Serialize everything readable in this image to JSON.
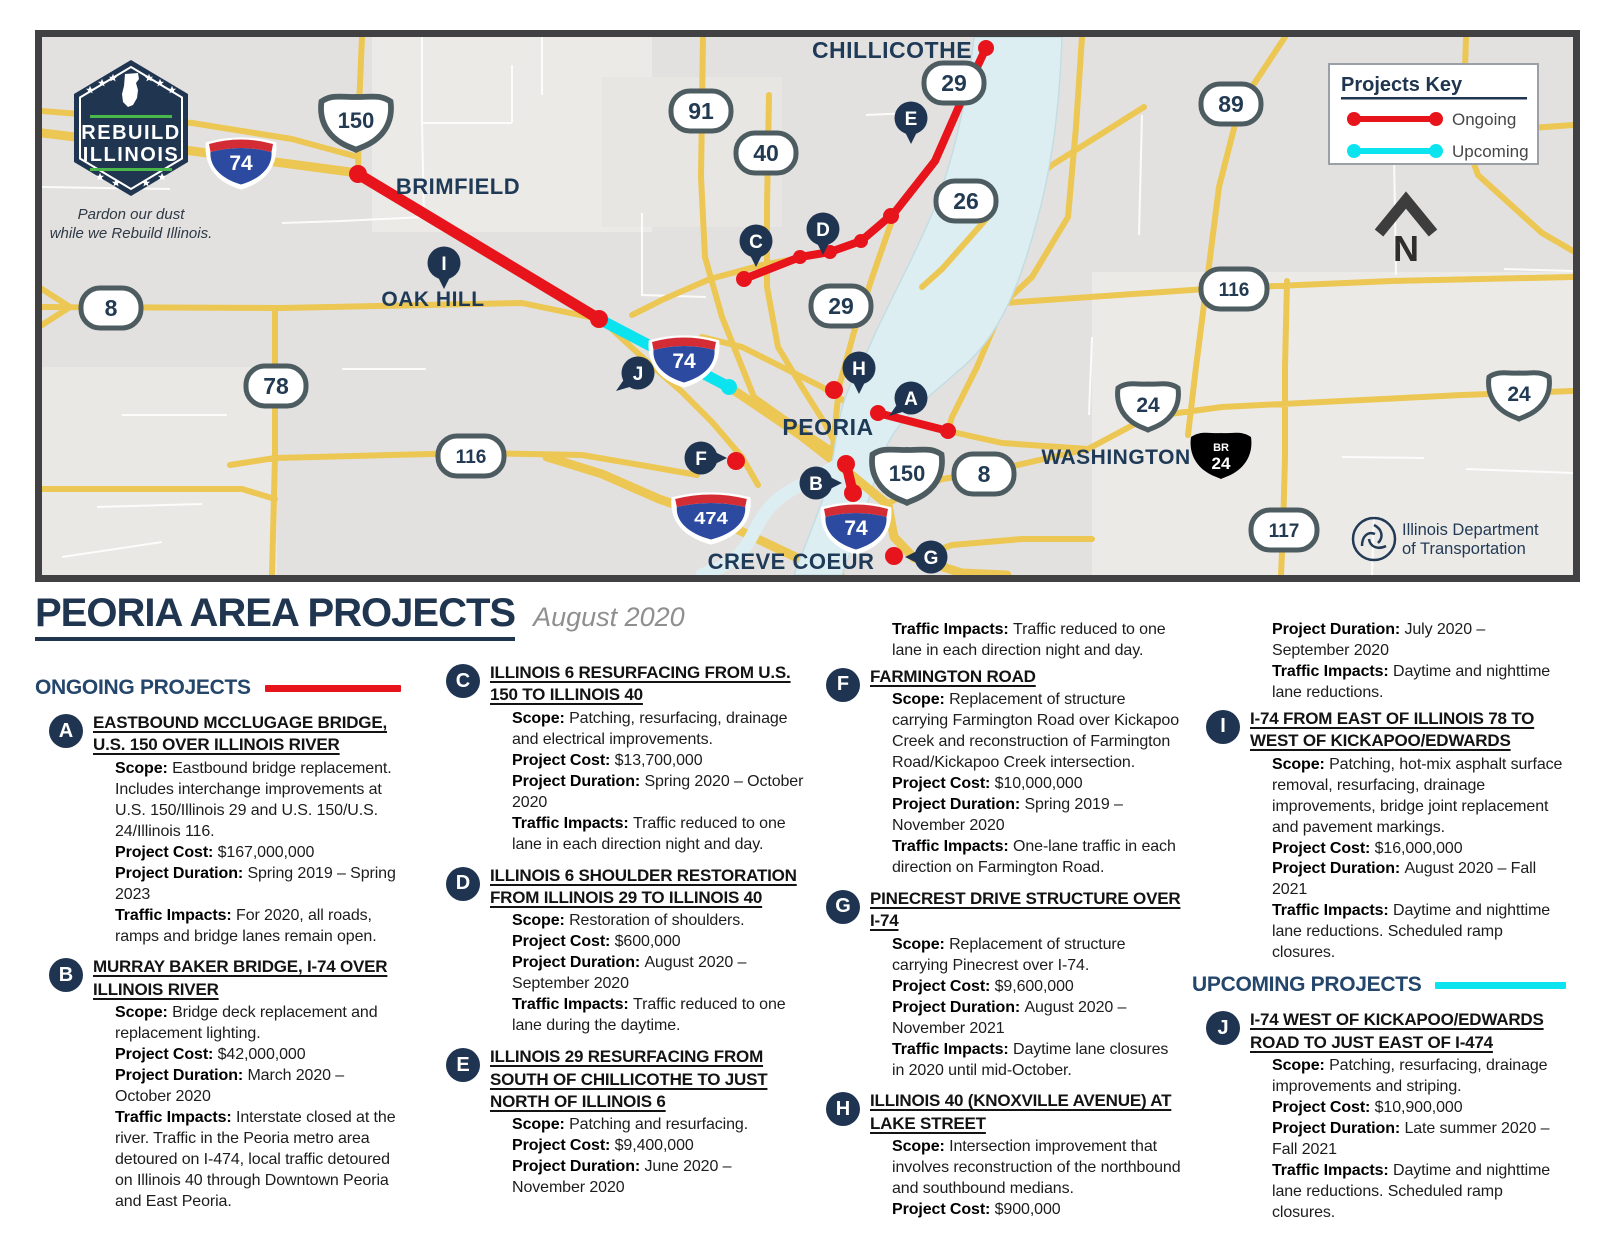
{
  "header": {
    "title": "PEORIA AREA PROJECTS",
    "date": "August 2020"
  },
  "sections": {
    "ongoing": {
      "label": "ONGOING PROJECTS",
      "color": "#e8141c"
    },
    "upcoming": {
      "label": "UPCOMING PROJECTS",
      "color": "#0be4ef"
    }
  },
  "labels": {
    "scope": "Scope:",
    "cost": "Project Cost:",
    "duration": "Project Duration:",
    "impacts": "Traffic Impacts:"
  },
  "map": {
    "legend": {
      "title": "Projects Key",
      "ongoing": "Ongoing",
      "upcoming": "Upcoming",
      "ongoing_color": "#e8141c",
      "upcoming_color": "#0be4ef"
    },
    "compass": "N",
    "rebuild": {
      "l1": "REBUILD",
      "l2": "ILLINOIS",
      "t1": "Pardon our dust",
      "t2": "while we Rebuild Illinois."
    },
    "idot": {
      "l1": "Illinois Department",
      "l2": "of Transportation"
    },
    "cities": {
      "brimfield": "BRIMFIELD",
      "oakhill": "OAK HILL",
      "chillicothe": "CHILLICOTHE",
      "peoria": "PEORIA",
      "washington": "WASHINGTON",
      "crevecoeur": "CREVE COEUR"
    },
    "shields": {
      "r8": "8",
      "r78": "78",
      "r91": "91",
      "r40": "40",
      "r29": "29",
      "r26": "26",
      "r89": "89",
      "r116": "116",
      "r117": "117",
      "us150": "150",
      "us24": "24",
      "br": "BR",
      "br24": "24",
      "i74": "74",
      "i474": "474"
    },
    "markers": {
      "a": "A",
      "b": "B",
      "c": "C",
      "d": "D",
      "e": "E",
      "f": "F",
      "g": "G",
      "h": "H",
      "i": "I",
      "j": "J"
    }
  },
  "columns": [
    {
      "blocks": [
        {
          "kind": "section",
          "section": "ongoing"
        },
        {
          "kind": "project",
          "letter": "A",
          "title": "EASTBOUND MCCLUGAGE BRIDGE, U.S. 150 OVER ILLINOIS RIVER",
          "details": [
            [
              "scope",
              "Eastbound bridge replacement. Includes interchange improvements at U.S. 150/Illinois 29 and U.S. 150/U.S. 24/Illinois 116."
            ],
            [
              "cost",
              "$167,000,000"
            ],
            [
              "duration",
              "Spring 2019 – Spring 2023"
            ],
            [
              "impacts",
              "For 2020, all roads, ramps and bridge lanes remain open."
            ]
          ]
        },
        {
          "kind": "project",
          "letter": "B",
          "title": "MURRAY BAKER BRIDGE, I-74 OVER ILLINOIS RIVER",
          "details": [
            [
              "scope",
              "Bridge deck replacement and replacement lighting."
            ],
            [
              "cost",
              "$42,000,000"
            ],
            [
              "duration",
              "March 2020 – October 2020"
            ],
            [
              "impacts",
              "Interstate closed at the river. Traffic in the Peoria metro area detoured on I-474, local traffic detoured on Illinois 40 through Downtown Peoria and East Peoria."
            ]
          ]
        }
      ]
    },
    {
      "blocks": [
        {
          "kind": "project",
          "letter": "C",
          "title": "ILLINOIS 6 RESURFACING FROM U.S. 150 TO ILLINOIS 40",
          "details": [
            [
              "scope",
              "Patching, resurfacing, drainage and electrical improvements."
            ],
            [
              "cost",
              "$13,700,000"
            ],
            [
              "duration",
              "Spring 2020 – October 2020"
            ],
            [
              "impacts",
              "Traffic reduced to one lane in each direction night and day."
            ]
          ]
        },
        {
          "kind": "project",
          "letter": "D",
          "title": "ILLINOIS 6 SHOULDER RESTORATION FROM ILLINOIS 29 TO ILLINOIS 40",
          "details": [
            [
              "scope",
              "Restoration of shoulders."
            ],
            [
              "cost",
              "$600,000"
            ],
            [
              "duration",
              "August 2020 – September 2020"
            ],
            [
              "impacts",
              "Traffic reduced to one lane during the daytime."
            ]
          ]
        },
        {
          "kind": "project",
          "letter": "E",
          "title": "ILLINOIS 29 RESURFACING FROM SOUTH OF CHILLICOTHE TO JUST NORTH OF ILLINOIS 6",
          "details": [
            [
              "scope",
              "Patching and resurfacing."
            ],
            [
              "cost",
              "$9,400,000"
            ],
            [
              "duration",
              "June 2020 – November 2020"
            ]
          ]
        }
      ]
    },
    {
      "blocks": [
        {
          "kind": "cont",
          "details": [
            [
              "impacts",
              "Traffic reduced to one lane in each direction night and day."
            ]
          ]
        },
        {
          "kind": "project",
          "letter": "F",
          "title": "FARMINGTON ROAD",
          "details": [
            [
              "scope",
              "Replacement of structure carrying Farmington Road over Kickapoo Creek and reconstruction of Farmington Road/Kickapoo Creek intersection."
            ],
            [
              "cost",
              "$10,000,000"
            ],
            [
              "duration",
              "Spring 2019 – November 2020"
            ],
            [
              "impacts",
              "One-lane traffic in each direction on Farmington Road."
            ]
          ]
        },
        {
          "kind": "project",
          "letter": "G",
          "title": "PINECREST DRIVE STRUCTURE OVER I-74",
          "details": [
            [
              "scope",
              "Replacement of structure carrying Pinecrest over I-74."
            ],
            [
              "cost",
              "$9,600,000"
            ],
            [
              "duration",
              "August 2020 – November 2021"
            ],
            [
              "impacts",
              "Daytime lane closures in 2020 until mid-October."
            ]
          ]
        },
        {
          "kind": "project",
          "letter": "H",
          "title": "ILLINOIS 40 (KNOXVILLE AVENUE) AT LAKE STREET",
          "details": [
            [
              "scope",
              "Intersection improvement that involves reconstruction of the northbound and southbound medians."
            ],
            [
              "cost",
              "$900,000"
            ]
          ]
        }
      ]
    },
    {
      "blocks": [
        {
          "kind": "cont",
          "details": [
            [
              "duration",
              "July 2020 – September 2020"
            ],
            [
              "impacts",
              "Daytime and nighttime lane reductions."
            ]
          ]
        },
        {
          "kind": "project",
          "letter": "I",
          "title": "I-74 FROM EAST OF ILLINOIS 78 TO WEST OF KICKAPOO/EDWARDS",
          "details": [
            [
              "scope",
              "Patching, hot-mix asphalt surface removal, resurfacing, drainage improvements, bridge joint replacement and pavement markings."
            ],
            [
              "cost",
              "$16,000,000"
            ],
            [
              "duration",
              "August 2020 – Fall 2021"
            ],
            [
              "impacts",
              "Daytime and nighttime lane reductions. Scheduled ramp closures."
            ]
          ]
        },
        {
          "kind": "section",
          "section": "upcoming"
        },
        {
          "kind": "project",
          "letter": "J",
          "title": "I-74 WEST OF KICKAPOO/EDWARDS ROAD TO JUST EAST OF I-474",
          "details": [
            [
              "scope",
              "Patching, resurfacing, drainage improvements and striping."
            ],
            [
              "cost",
              "$10,900,000"
            ],
            [
              "duration",
              "Late summer 2020 – Fall 2021"
            ],
            [
              "impacts",
              "Daytime and nighttime lane reductions. Scheduled ramp closures."
            ]
          ]
        }
      ]
    }
  ]
}
